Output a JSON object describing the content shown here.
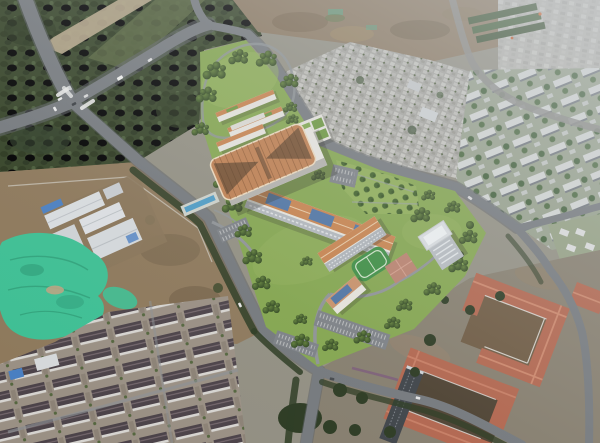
{
  "scene": {
    "type": "aerial-photograph",
    "subject": "Architectural rendering of a new campus composited into a drone aerial photo of its urban surroundings",
    "lighting": "hazy daylight, haze strongest toward the upper right",
    "camera": "high oblique aerial view"
  },
  "regions": {
    "campus": {
      "label": "new campus rendering",
      "features": [
        "terracotta butterfly canopy roof",
        "orange-roofed wings",
        "rooftop lawn grids",
        "rooftop solar panels",
        "green sports field",
        "white mid-rise tower",
        "orchard tree grid",
        "parking lots",
        "linear pool",
        "tree-lined lawns"
      ]
    },
    "northwest_vegetation": {
      "label": "dense roadside forest with graded dirt strip"
    },
    "highway_interchange": {
      "label": "four-way road intersection with crosswalks, medians and cars"
    },
    "industrial_yard": {
      "label": "white warehouse compound on bare earth with blue tarps"
    },
    "mesh_mound": {
      "label": "construction spoil covered by bright green dust netting"
    },
    "rowhouse_district": {
      "label": "parallel rows of dark-roofed townhouses"
    },
    "red_roof_campus": {
      "label": "U-shaped terracotta-roofed institutional buildings with dirt courtyards"
    },
    "urban_village": {
      "label": "dense low-rise urban village blocks"
    },
    "apartment_district": {
      "label": "apartment slabs between street trees"
    },
    "cleared_land": {
      "label": "brown graded construction land with green net patches"
    },
    "roads": {
      "label": "gray asphalt roads with dark street-tree verges"
    }
  },
  "colors": {
    "base": "#928f82",
    "campus_lawn": "#84a64f",
    "canopy_roof": "#bf7f50",
    "roof_orange": "#c8834e",
    "solar_blue": "#4f74a4",
    "field_green": "#3e8e44",
    "tower_roof": "#d9dde0",
    "pool_blue": "#4f9cc4",
    "mesh_green": "#3fbf94",
    "red_roof": "#b2664e",
    "veg_dark": "#364428",
    "road_gray": "#75797d",
    "dirt_brown": "#8b7860",
    "housing_roof": "#4c4349",
    "warehouse_white": "#d9dcdf"
  }
}
